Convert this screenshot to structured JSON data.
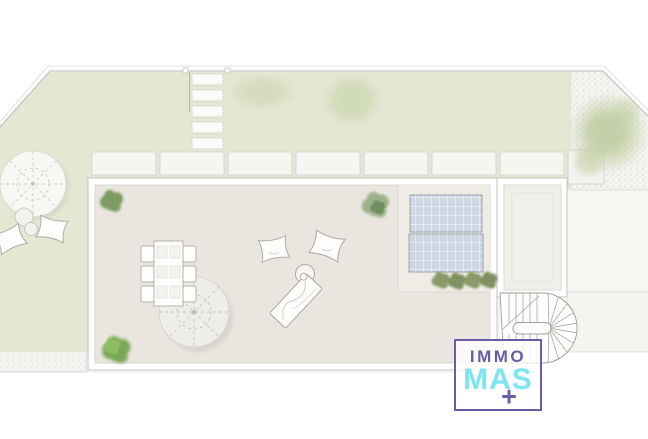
{
  "title": "Property site plan — roof terrace and garden (top view)",
  "logo": {
    "line1": "IMMO",
    "line2": "MAS",
    "plus_sign": "+"
  },
  "colors": {
    "logo_purple": "#685da6",
    "logo_cyan": "#7de5f2",
    "lawn_green": "#e4e8d3",
    "terrace_beige": "#eae6df",
    "roof_light": "#efece6",
    "annex_light": "#f1efe9",
    "gravel_light": "#f5f4f1",
    "panel_blue": "#ced6e4",
    "bush_green": "#7fa463",
    "tree_green": "#c4d0a6",
    "outline_gray": "#c2c2c0"
  },
  "plan": {
    "features": [
      "garden-lawn",
      "gravel-courtyard",
      "stepping-stone-path-5-stones",
      "paver-walkway-7-slabs",
      "roof-terrace",
      "annex-roof",
      "spiral-staircase",
      "solar-panels-2",
      "dining-table-6-chairs",
      "terrace-parasol",
      "garden-parasol",
      "bean-bag-cushions-4",
      "sun-lounger",
      "coffee-table",
      "garden-side-tables-2",
      "shrubs-and-plants",
      "trees-3"
    ]
  }
}
